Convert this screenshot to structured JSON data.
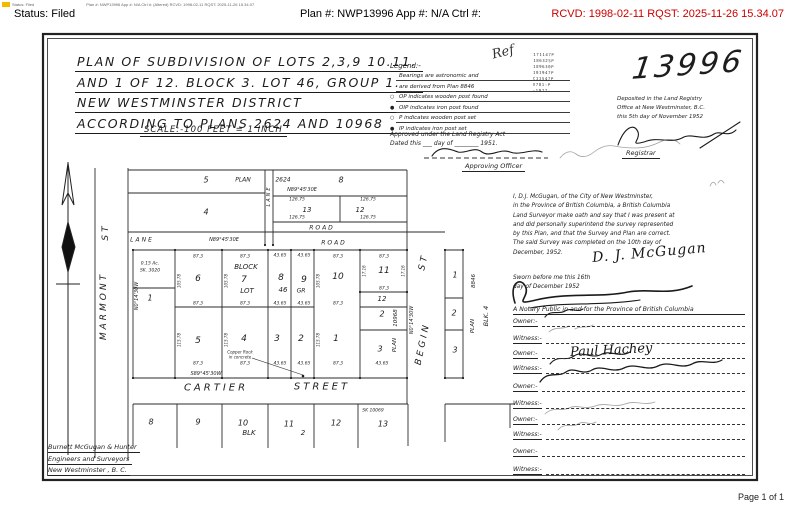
{
  "header": {
    "print_line_left": "Status: Filed",
    "print_line_right": "Plan #: NWP13996 App #: N/A Ctrl #:  (Altered) RCVD: 1998-02-11 RQST: 2025-11-26 15.34.07",
    "status_label": "Status: Filed",
    "plan_label": "Plan #: NWP13996 App #: N/A Ctrl #:",
    "rcvd_label": "RCVD: 1998-02-11 RQST: 2025-11-26 15.34.07",
    "rcvd_color": "#cc0000",
    "highlight_color": "#f6b700"
  },
  "footer": {
    "page_label": "Page 1 of 1"
  },
  "plan": {
    "plan_number": "13996",
    "title_lines": [
      "PLAN OF SUBDIVISION OF LOTS 2,3,9 10.11.",
      "AND 1 OF 12. BLOCK 3. LOT 46, GROUP 1.",
      "NEW WESTMINSTER DISTRICT",
      "ACCORDING TO PLANS 2624 AND 10968"
    ],
    "scale_line": "SCALE:-100 FEET = 1 INCH",
    "ref_note": "Ref",
    "stamp_numbers": [
      "171147P",
      "186325P",
      "189630P",
      "101947P",
      "C11547P",
      "V781-P",
      "-1977-"
    ],
    "legend": {
      "heading": "Legend:-",
      "items": [
        {
          "sym": "",
          "text": "Bearings are astronomic and"
        },
        {
          "sym": "",
          "text": "are derived from Plan 8846"
        },
        {
          "sym": "○",
          "text": "OP indicates wooden post found"
        },
        {
          "sym": "●",
          "text": "OIP indicates iron post found"
        },
        {
          "sym": "○",
          "text": "P indicates wooden post set"
        },
        {
          "sym": "●",
          "text": "IP indicates iron post set"
        }
      ]
    },
    "approval": {
      "line1": "Approved under the Land Registry Act",
      "line2": "Dated this ___ day of ________ 1951.",
      "officer_label": "Approving Officer"
    },
    "deposit": {
      "lines": [
        "Deposited in the Land Registry",
        "Office at New Westminster, B.C.",
        "this 5th day of November 1952"
      ],
      "registrar_label": "Registrar"
    },
    "affidavit": {
      "lines": [
        "I, D.J. McGugan, of the City of New Westminster,",
        "in the Province of British Columbia, a British Columbia",
        "Land Surveyor make oath and say that I was present at",
        "and did personally superintend the survey represented",
        "by this Plan, and that the Survey and Plan are correct.",
        "The said Survey was completed on the 10th day of",
        "December, 1952."
      ],
      "signature": "D. J. McGugan"
    },
    "sworn": {
      "lines": [
        "Sworn before me this 16th",
        "day of December 1952"
      ],
      "notary_label": "A Notary Public in and for the Province of British Columbia"
    },
    "owner_rows": [
      {
        "label": "Owner:-",
        "y": 314,
        "name": ""
      },
      {
        "label": "Witness:-",
        "y": 331,
        "name": ""
      },
      {
        "label": "Owner:-",
        "y": 346,
        "name": "Paul Hachey"
      },
      {
        "label": "Witness:-",
        "y": 361,
        "name": ""
      },
      {
        "label": "Owner:-",
        "y": 379,
        "name": ""
      },
      {
        "label": "Witness:-",
        "y": 396,
        "name": ""
      },
      {
        "label": "Owner:-",
        "y": 412,
        "name": ""
      },
      {
        "label": "Witness:-",
        "y": 427,
        "name": ""
      },
      {
        "label": "Owner:-",
        "y": 444,
        "name": ""
      },
      {
        "label": "Witness:-",
        "y": 462,
        "name": ""
      }
    ],
    "firm_lines": [
      "Burnett McGugan & Hunter",
      "Engineers and Surveyors",
      "New Westminster , B. C."
    ],
    "map": {
      "street_names": [
        "MARMONT ST",
        "BEGIN ST",
        "CARTIER STREET",
        "LANE",
        "ROAD"
      ],
      "labels": [
        {
          "t": "ST",
          "x": 106,
          "y": 232,
          "s": 9,
          "r": -90,
          "c": "street"
        },
        {
          "t": "MARMONT",
          "x": 104,
          "y": 306,
          "s": 9,
          "r": -90,
          "c": "street"
        },
        {
          "t": "ST",
          "x": 424,
          "y": 262,
          "s": 9,
          "r": -78,
          "c": "street"
        },
        {
          "t": "BEGIN",
          "x": 423,
          "y": 344,
          "s": 9,
          "r": -78,
          "c": "street"
        },
        {
          "t": "CARTIER",
          "x": 216,
          "y": 388,
          "s": 10,
          "c": "street"
        },
        {
          "t": "STREET",
          "x": 322,
          "y": 387,
          "s": 10,
          "c": "street"
        },
        {
          "t": "LANE",
          "x": 142,
          "y": 240,
          "s": 6,
          "c": "street2"
        },
        {
          "t": "LANE",
          "x": 269,
          "y": 196,
          "s": 5,
          "r": -90,
          "c": "street2"
        },
        {
          "t": "ROAD",
          "x": 322,
          "y": 228,
          "s": 6,
          "c": "street2"
        },
        {
          "t": "ROAD",
          "x": 334,
          "y": 243,
          "s": 6,
          "c": "street2"
        },
        {
          "t": "N89°45'30E",
          "x": 224,
          "y": 240,
          "s": 5
        },
        {
          "t": "N89°45'30E",
          "x": 302,
          "y": 190,
          "s": 5
        },
        {
          "t": "S89°45'30W",
          "x": 206,
          "y": 374,
          "s": 5
        },
        {
          "t": "N0°14'30W",
          "x": 137,
          "y": 296,
          "s": 5,
          "r": -90
        },
        {
          "t": "N0°14'30W",
          "x": 412,
          "y": 320,
          "s": 5,
          "r": -90
        },
        {
          "t": "5",
          "x": 206,
          "y": 180,
          "s": 8
        },
        {
          "t": "PLAN",
          "x": 243,
          "y": 180,
          "s": 6
        },
        {
          "t": "2624",
          "x": 283,
          "y": 180,
          "s": 6
        },
        {
          "t": "8",
          "x": 341,
          "y": 180,
          "s": 8
        },
        {
          "t": "4",
          "x": 206,
          "y": 212,
          "s": 8
        },
        {
          "t": "13",
          "x": 307,
          "y": 210,
          "s": 7
        },
        {
          "t": "12",
          "x": 360,
          "y": 210,
          "s": 7
        },
        {
          "t": "126.75",
          "x": 297,
          "y": 200,
          "s": 4.5
        },
        {
          "t": "126.75",
          "x": 368,
          "y": 200,
          "s": 4.5
        },
        {
          "t": "126.75",
          "x": 297,
          "y": 218,
          "s": 4.5
        },
        {
          "t": "126.75",
          "x": 368,
          "y": 218,
          "s": 4.5
        },
        {
          "t": "BLOCK",
          "x": 246,
          "y": 267,
          "s": 7
        },
        {
          "t": "7",
          "x": 244,
          "y": 280,
          "s": 9
        },
        {
          "t": "LOT",
          "x": 247,
          "y": 291,
          "s": 7
        },
        {
          "t": "6",
          "x": 198,
          "y": 279,
          "s": 9
        },
        {
          "t": "8",
          "x": 281,
          "y": 278,
          "s": 9
        },
        {
          "t": "46",
          "x": 283,
          "y": 290,
          "s": 7
        },
        {
          "t": "9",
          "x": 304,
          "y": 280,
          "s": 9
        },
        {
          "t": "GR",
          "x": 301,
          "y": 291,
          "s": 6
        },
        {
          "t": "10",
          "x": 338,
          "y": 277,
          "s": 9
        },
        {
          "t": "11",
          "x": 384,
          "y": 271,
          "s": 9
        },
        {
          "t": "12",
          "x": 382,
          "y": 299,
          "s": 7
        },
        {
          "t": "0.15 Ac.",
          "x": 150,
          "y": 264,
          "s": 4.5
        },
        {
          "t": "SK. 3020",
          "x": 150,
          "y": 271,
          "s": 4.5
        },
        {
          "t": "1",
          "x": 150,
          "y": 298,
          "s": 8
        },
        {
          "t": "5",
          "x": 198,
          "y": 341,
          "s": 9
        },
        {
          "t": "4",
          "x": 244,
          "y": 339,
          "s": 9
        },
        {
          "t": "3",
          "x": 277,
          "y": 339,
          "s": 9
        },
        {
          "t": "2",
          "x": 301,
          "y": 339,
          "s": 9
        },
        {
          "t": "1",
          "x": 336,
          "y": 339,
          "s": 9
        },
        {
          "t": "2",
          "x": 382,
          "y": 314,
          "s": 8
        },
        {
          "t": "3",
          "x": 380,
          "y": 349,
          "s": 8
        },
        {
          "t": "PLAN",
          "x": 395,
          "y": 345,
          "s": 5.5,
          "r": -90
        },
        {
          "t": "10968",
          "x": 396,
          "y": 318,
          "s": 5.5,
          "r": -90
        },
        {
          "t": "1",
          "x": 455,
          "y": 275,
          "s": 8
        },
        {
          "t": "2",
          "x": 454,
          "y": 313,
          "s": 8
        },
        {
          "t": "3",
          "x": 455,
          "y": 350,
          "s": 8
        },
        {
          "t": "8846",
          "x": 474,
          "y": 281,
          "s": 5.5,
          "r": -90
        },
        {
          "t": "PLAN",
          "x": 473,
          "y": 326,
          "s": 5.5,
          "r": -90
        },
        {
          "t": "BLK. 4",
          "x": 486,
          "y": 316,
          "s": 6.5,
          "r": -90
        },
        {
          "t": "87.3",
          "x": 198,
          "y": 257,
          "s": 4.5
        },
        {
          "t": "87.3",
          "x": 245,
          "y": 257,
          "s": 4.5
        },
        {
          "t": "43.65",
          "x": 280,
          "y": 256,
          "s": 4.5
        },
        {
          "t": "43.65",
          "x": 304,
          "y": 256,
          "s": 4.5
        },
        {
          "t": "87.3",
          "x": 338,
          "y": 257,
          "s": 4.5
        },
        {
          "t": "87.3",
          "x": 384,
          "y": 257,
          "s": 4.5
        },
        {
          "t": "87.3",
          "x": 198,
          "y": 304,
          "s": 4.5
        },
        {
          "t": "87.3",
          "x": 245,
          "y": 304,
          "s": 4.5
        },
        {
          "t": "43.65",
          "x": 280,
          "y": 304,
          "s": 4.5
        },
        {
          "t": "43.65",
          "x": 304,
          "y": 304,
          "s": 4.5
        },
        {
          "t": "87.3",
          "x": 338,
          "y": 304,
          "s": 4.5
        },
        {
          "t": "87.3",
          "x": 384,
          "y": 289,
          "s": 4.5
        },
        {
          "t": "87.3",
          "x": 198,
          "y": 364,
          "s": 4.5
        },
        {
          "t": "87.3",
          "x": 245,
          "y": 364,
          "s": 4.5
        },
        {
          "t": "43.65",
          "x": 280,
          "y": 364,
          "s": 4.5
        },
        {
          "t": "43.65",
          "x": 304,
          "y": 364,
          "s": 4.5
        },
        {
          "t": "87.3",
          "x": 338,
          "y": 364,
          "s": 4.5
        },
        {
          "t": "43.65",
          "x": 382,
          "y": 364,
          "s": 4.5
        },
        {
          "t": "105.78",
          "x": 179,
          "y": 281,
          "s": 4,
          "r": -90
        },
        {
          "t": "105.78",
          "x": 226,
          "y": 281,
          "s": 4,
          "r": -90
        },
        {
          "t": "105.78",
          "x": 318,
          "y": 281,
          "s": 4,
          "r": -90
        },
        {
          "t": "115.78",
          "x": 179,
          "y": 340,
          "s": 4,
          "r": -90
        },
        {
          "t": "115.78",
          "x": 226,
          "y": 340,
          "s": 4,
          "r": -90
        },
        {
          "t": "115.78",
          "x": 318,
          "y": 340,
          "s": 4,
          "r": -90
        },
        {
          "t": "17.16",
          "x": 364,
          "y": 271,
          "s": 4,
          "r": -90
        },
        {
          "t": "17.16",
          "x": 403,
          "y": 271,
          "s": 4,
          "r": -90
        },
        {
          "t": "Copper Rock",
          "x": 240,
          "y": 352,
          "s": 4
        },
        {
          "t": "in concrete",
          "x": 240,
          "y": 357,
          "s": 4
        },
        {
          "t": "8",
          "x": 151,
          "y": 422,
          "s": 8
        },
        {
          "t": "9",
          "x": 198,
          "y": 422,
          "s": 8
        },
        {
          "t": "10",
          "x": 243,
          "y": 423,
          "s": 8
        },
        {
          "t": "11",
          "x": 289,
          "y": 424,
          "s": 8
        },
        {
          "t": "12",
          "x": 336,
          "y": 423,
          "s": 8
        },
        {
          "t": "13",
          "x": 383,
          "y": 424,
          "s": 8
        },
        {
          "t": "SK 10069",
          "x": 373,
          "y": 411,
          "s": 4.5
        },
        {
          "t": "BLK",
          "x": 249,
          "y": 433,
          "s": 7
        },
        {
          "t": "2",
          "x": 303,
          "y": 433,
          "s": 7
        }
      ]
    }
  }
}
